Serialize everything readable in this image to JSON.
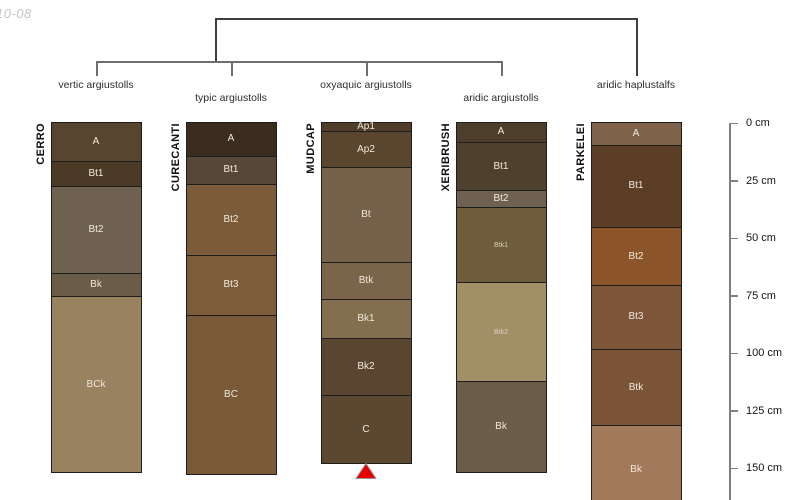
{
  "watermark": "10-08",
  "dendrogram": {
    "groups": [
      {
        "label": "vertic argiustolls",
        "label_row": "upper"
      },
      {
        "label": "typic argiustolls",
        "label_row": "lower"
      },
      {
        "label": "oxyaquic argiustolls",
        "label_row": "upper"
      },
      {
        "label": "aridic argiustolls",
        "label_row": "lower"
      },
      {
        "label": "aridic haplustalfs",
        "label_row": "upper"
      }
    ],
    "structure": "leaves 1-4 join in one low cluster; that cluster joins leaf 5 (aridic haplustalfs) at the root"
  },
  "depth_axis": {
    "unit": "cm",
    "ticks_cm": [
      0,
      25,
      50,
      75,
      100,
      125,
      150
    ],
    "tick_labels": [
      "0 cm",
      "25 cm",
      "50 cm",
      "75 cm",
      "100 cm",
      "125 cm",
      "150 cm"
    ]
  },
  "chart_data": {
    "type": "soil-profile-columns",
    "description": "Five soil series profiles with horizon depths (cm), aligned to a shared depth scale; dendrogram above groups them by taxonomic classification.",
    "profiles": [
      {
        "series": "CERRO",
        "classification": "vertic argiustolls",
        "marker": null,
        "horizons": [
          {
            "name": "A",
            "top_cm": 0,
            "bottom_cm": 17,
            "color": "#57452f"
          },
          {
            "name": "Bt1",
            "top_cm": 17,
            "bottom_cm": 28,
            "color": "#4b3a26"
          },
          {
            "name": "Bt2",
            "top_cm": 28,
            "bottom_cm": 66,
            "color": "#6e6150"
          },
          {
            "name": "Bk",
            "top_cm": 66,
            "bottom_cm": 76,
            "color": "#6b5c48"
          },
          {
            "name": "BCk",
            "top_cm": 76,
            "bottom_cm": 152,
            "color": "#99825f"
          }
        ]
      },
      {
        "series": "CURECANTI",
        "classification": "typic argiustolls",
        "marker": null,
        "horizons": [
          {
            "name": "A",
            "top_cm": 0,
            "bottom_cm": 15,
            "color": "#3a2c1e"
          },
          {
            "name": "Bt1",
            "top_cm": 15,
            "bottom_cm": 27,
            "color": "#564736"
          },
          {
            "name": "Bt2",
            "top_cm": 27,
            "bottom_cm": 58,
            "color": "#7c5b3a"
          },
          {
            "name": "Bt3",
            "top_cm": 58,
            "bottom_cm": 84,
            "color": "#7d5c3b"
          },
          {
            "name": "BC",
            "top_cm": 84,
            "bottom_cm": 153,
            "color": "#7a5939"
          }
        ]
      },
      {
        "series": "MUDCAP",
        "classification": "oxyaquic argiustolls",
        "marker": "red-triangle",
        "horizons": [
          {
            "name": "Ap1",
            "top_cm": 0,
            "bottom_cm": 4,
            "color": "#503d29"
          },
          {
            "name": "Ap2",
            "top_cm": 4,
            "bottom_cm": 20,
            "color": "#5a452e"
          },
          {
            "name": "Bt",
            "top_cm": 20,
            "bottom_cm": 61,
            "color": "#76624a"
          },
          {
            "name": "Btk",
            "top_cm": 61,
            "bottom_cm": 77,
            "color": "#7b654a"
          },
          {
            "name": "Bk1",
            "top_cm": 77,
            "bottom_cm": 94,
            "color": "#836e50"
          },
          {
            "name": "Bk2",
            "top_cm": 94,
            "bottom_cm": 119,
            "color": "#5a4630"
          },
          {
            "name": "C",
            "top_cm": 119,
            "bottom_cm": 148,
            "color": "#5c4831"
          }
        ]
      },
      {
        "series": "XERIBRUSH",
        "classification": "aridic argiustolls",
        "marker": null,
        "horizons": [
          {
            "name": "A",
            "top_cm": 0,
            "bottom_cm": 9,
            "color": "#4d3e2b"
          },
          {
            "name": "Bt1",
            "top_cm": 9,
            "bottom_cm": 30,
            "color": "#4f402d"
          },
          {
            "name": "Bt2",
            "top_cm": 30,
            "bottom_cm": 37,
            "color": "#6e6152"
          },
          {
            "name": "Btk1",
            "top_cm": 37,
            "bottom_cm": 70,
            "color": "#6f5c3a",
            "label_size": "small"
          },
          {
            "name": "Btk2",
            "top_cm": 70,
            "bottom_cm": 113,
            "color": "#a38f66",
            "label_size": "small"
          },
          {
            "name": "Bk",
            "top_cm": 113,
            "bottom_cm": 152,
            "color": "#6a5c47"
          }
        ]
      },
      {
        "series": "PARKELEI",
        "classification": "aridic haplustalfs",
        "marker": null,
        "horizons": [
          {
            "name": "A",
            "top_cm": 0,
            "bottom_cm": 10,
            "color": "#7e6249"
          },
          {
            "name": "Bt1",
            "top_cm": 10,
            "bottom_cm": 46,
            "color": "#5c3e27"
          },
          {
            "name": "Bt2",
            "top_cm": 46,
            "bottom_cm": 71,
            "color": "#8b5529"
          },
          {
            "name": "Bt3",
            "top_cm": 71,
            "bottom_cm": 99,
            "color": "#7d5639"
          },
          {
            "name": "Btk",
            "top_cm": 99,
            "bottom_cm": 132,
            "color": "#7b5438"
          },
          {
            "name": "Bk",
            "top_cm": 132,
            "bottom_cm": null,
            "color": "#a27a5b",
            "cut_off_at_view": true
          }
        ]
      }
    ],
    "marker_color": "#e60000"
  }
}
